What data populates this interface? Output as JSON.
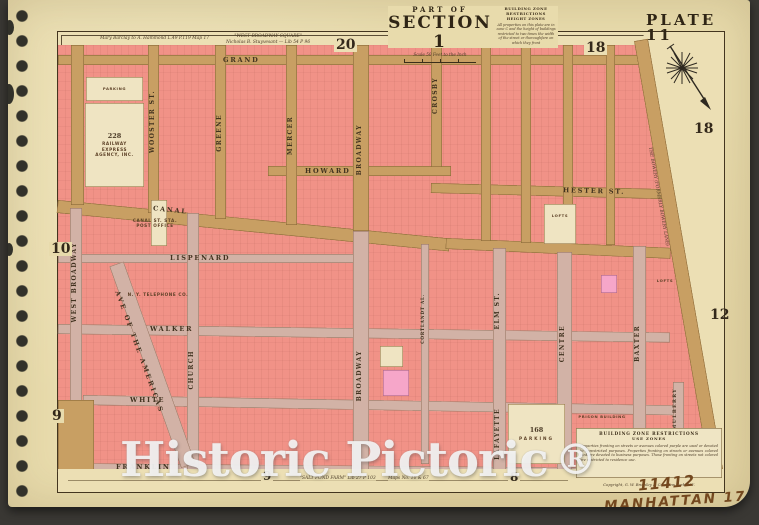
{
  "page": {
    "watermark": "Historic Pictoric",
    "watermark_reg": "®",
    "handwritten_number": "11412",
    "handwritten_label": "MANHATTAN 175"
  },
  "titleblock": {
    "part_of": "PART OF",
    "section": "SECTION 1",
    "scale": "Scale 50 Feet to the Inch",
    "plate": "PLATE 11",
    "height_zones_title": "BUILDING ZONE RESTRICTIONS",
    "height_zones_sub": "HEIGHT ZONES",
    "height_zones_text": "All properties on this plate are in zone C and the height of buildings restricted to two times the width of the street or thoroughfare on which they front"
  },
  "use_zones": {
    "title": "BUILDING ZONE RESTRICTIONS",
    "sub": "USE ZONES",
    "text": "Properties fronting on streets or avenues colored purple are used or devoted to unrestricted purposes. Properties fronting on streets or avenues colored pink are devoted to business purposes. Those fronting on streets not colored are restricted to residence use.",
    "copyright": "Copyright, G. W. Bromley & Co., New York, N.Y."
  },
  "annotations": {
    "top_left": "Mary Barclay to A. Hammond  L.49 P.119 Map 17",
    "top_right_1": "\"WEST BROADWAY SQUARE\"",
    "top_right_2": "Nicholas B. Stuyvesant — Lib 54 P 96",
    "bottom_1": "\"SALT POND FARM\"  Lib 27 P 103",
    "bottom_2": "Maps No. 10 & 67",
    "bowery": "THE BOWERY (FORMERLY BOWERY LANE)"
  },
  "margin_numbers": {
    "top_left": "20",
    "top_right": "18",
    "right_upper": "18",
    "right_lower": "12",
    "left_upper": "10",
    "left_lower": "9",
    "bottom_left": "9",
    "bottom_right": "8"
  },
  "streets": {
    "grand": "GRAND",
    "howard": "HOWARD",
    "hester": "HESTER ST.",
    "canal": "CANAL",
    "lispenard": "LISPENARD",
    "walker": "WALKER",
    "white": "WHITE",
    "franklin": "FRANKLIN",
    "west_broadway": "WEST BROADWAY",
    "wooster": "WOOSTER ST.",
    "greene": "GREENE",
    "mercer": "MERCER",
    "broadway": "BROADWAY",
    "crosby": "CROSBY",
    "church": "CHURCH",
    "cortlandt": "CORTLANDT AL.",
    "elm": "ELM ST.",
    "lafayette": "LAFAYETTE",
    "centre": "CENTRE",
    "baxter": "BAXTER",
    "mulberry": "MULBERRY",
    "sixth_ave": "AVE OF THE AMERICAS"
  },
  "buildings": {
    "parking_label": "PARKING",
    "railway_number": "228",
    "railway_name": "RAILWAY EXPRESS AGENCY, INC.",
    "post_office_line1": "CANAL ST. STA.",
    "post_office_line2": "POST OFFICE",
    "telephone": "N. Y. TELEPHONE CO.",
    "parking168_number": "168",
    "parking168_label": "PARKING",
    "prison": "PRISON BUILDING",
    "lofts_a": "LOFTS",
    "lofts_b": "LOFTS"
  }
}
